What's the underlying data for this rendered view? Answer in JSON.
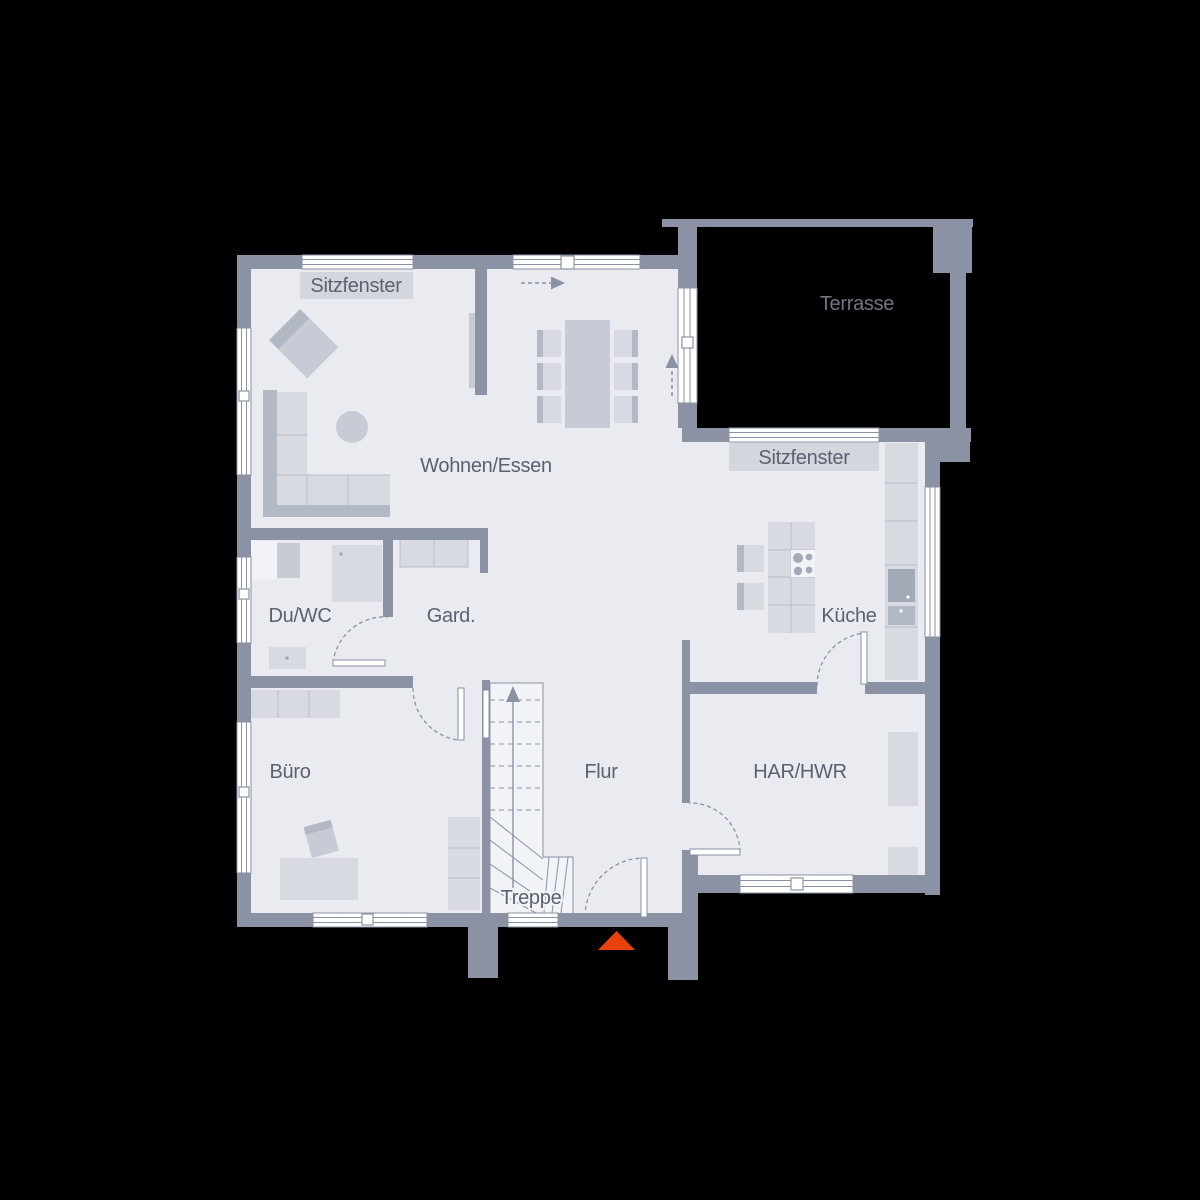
{
  "plan": {
    "kind": "floor-plan",
    "rooms": {
      "living_dining": "Wohnen/Essen",
      "shower_wc": "Du/WC",
      "cloakroom": "Gard.",
      "kitchen": "Küche",
      "office": "Büro",
      "hallway": "Flur",
      "utility_room": "HAR/HWR",
      "staircase": "Treppe",
      "terrace": "Terrasse",
      "seat_window_top": "Sitzfenster",
      "seat_window_right": "Sitzfenster"
    }
  },
  "colors": {
    "background": "#000000",
    "wall": "#8A92A3",
    "floor": "#E9EBF0",
    "furniture_light": "#D7DAE1",
    "furniture_mid": "#C6CBD5",
    "furniture_dark": "#B2B8C4",
    "furniture_line": "#B9BFCA",
    "appliance": "#A2AAB8",
    "window_white": "#FFFFFF",
    "label_box": "#D3D6DD",
    "text_color": "#5A6170",
    "terrace_text": "#6E7585",
    "stair_fill": "#F2F3F7",
    "entrance_marker": "#E8430C"
  }
}
